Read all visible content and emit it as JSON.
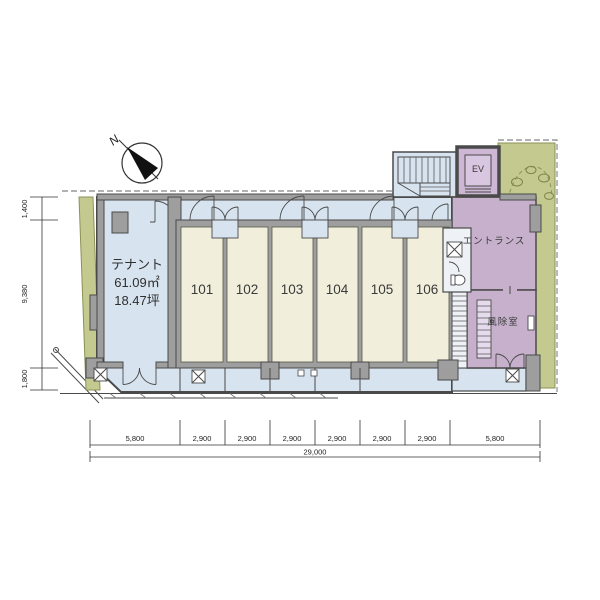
{
  "plan": {
    "north_label": "N",
    "tenant": {
      "name": "テナント",
      "area": "61.09㎡",
      "area_tsubo": "18.47坪"
    },
    "rooms": [
      "101",
      "102",
      "103",
      "104",
      "105",
      "106"
    ],
    "elevator": "EV",
    "entrance": "エントランス",
    "windbreak_room": "風除室"
  },
  "dimensions": {
    "left": [
      "1,400",
      "9,380",
      "1,800"
    ],
    "bottom": [
      "5,800",
      "2,900",
      "2,900",
      "2,900",
      "2,900",
      "2,900",
      "2,900",
      "5,800"
    ],
    "total_width": "29,000"
  },
  "colors": {
    "room_fill": "#f1eedb",
    "common_fill": "#d7e3ee",
    "entrance_fill": "#c6b0cc",
    "ev_fill": "#cdb7d4",
    "ev_car_fill": "#d9c6e0",
    "landscape_fill": "#c3c98f",
    "landscape_line": "#8c9257",
    "wall_fill": "#9e9e9e",
    "line": "#4a4a4a"
  }
}
